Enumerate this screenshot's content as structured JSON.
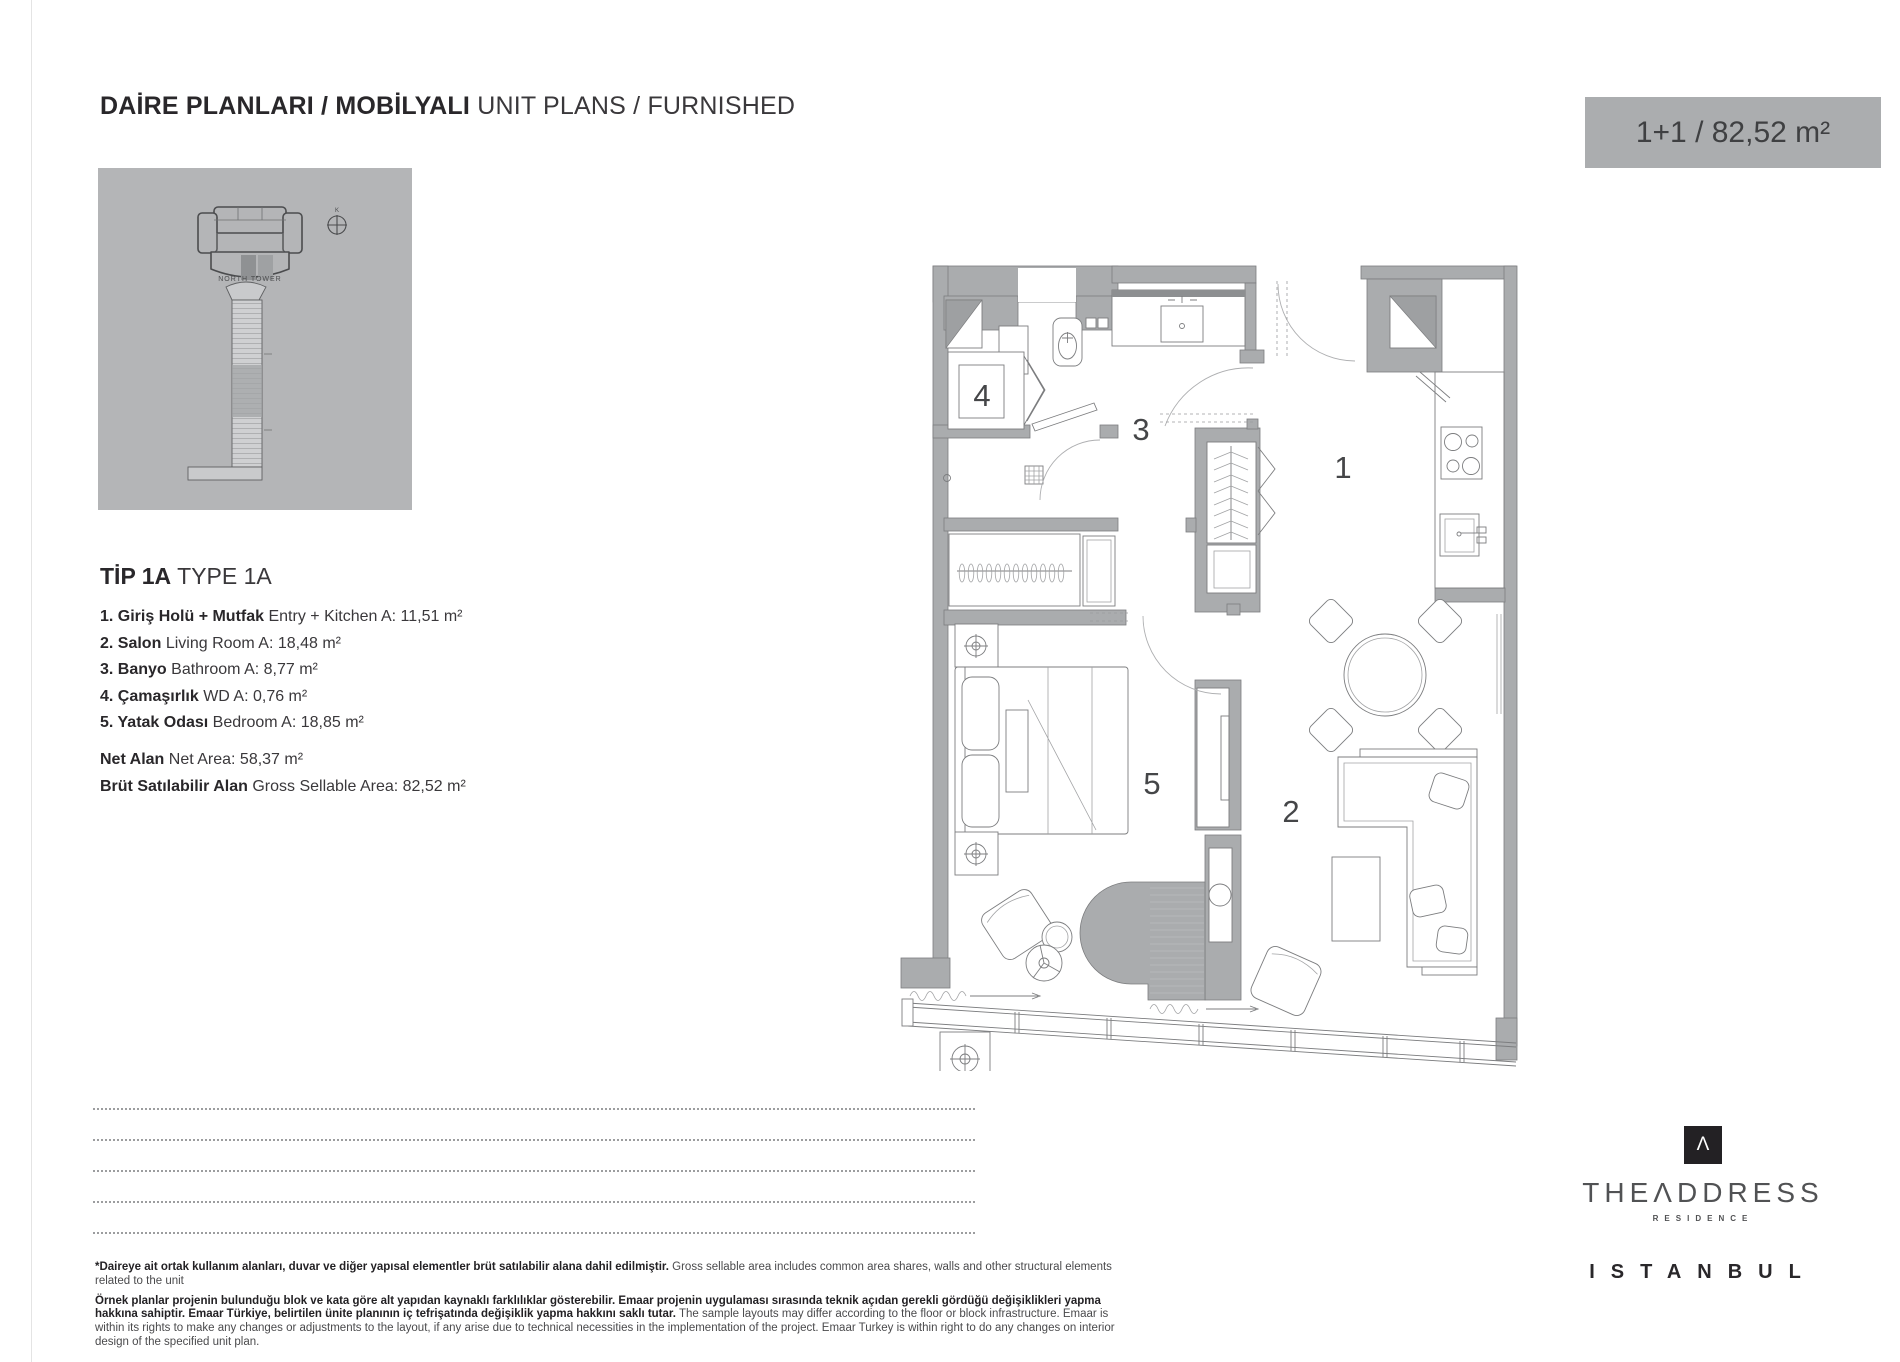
{
  "header": {
    "title_tr": "DAİRE PLANLARI / MOBİLYALI",
    "title_en": "UNIT PLANS / FURNISHED"
  },
  "unit_badge": "1+1 / 82,52 m²",
  "key_plan": {
    "north_letter": "K",
    "tower_name": "NORTH TOWER"
  },
  "unit_type": {
    "code_tr": "TİP 1A",
    "code_en": "TYPE 1A"
  },
  "rooms": [
    {
      "tr": "1. Giriş Holü + Mutfak",
      "en": "Entry + Kitchen A: 11,51 m²"
    },
    {
      "tr": "2. Salon",
      "en": "Living Room A: 18,48 m²"
    },
    {
      "tr": "3. Banyo",
      "en": "Bathroom A: 8,77 m²"
    },
    {
      "tr": "4. Çamaşırlık",
      "en": "WD A: 0,76 m²"
    },
    {
      "tr": "5. Yatak Odası",
      "en": "Bedroom A: 18,85 m²"
    }
  ],
  "totals": [
    {
      "tr": "Net Alan",
      "en": "Net Area: 58,37 m²"
    },
    {
      "tr": "Brüt Satılabilir Alan",
      "en": "Gross Sellable Area: 82,52 m²"
    }
  ],
  "floor_plan": {
    "labels": {
      "entry_kitchen": "1",
      "living_room": "2",
      "bathroom": "3",
      "wd": "4",
      "bedroom": "5"
    }
  },
  "disclaimer": {
    "p1_tr": "*Daireye ait ortak kullanım alanları, duvar ve diğer yapısal elementler brüt satılabilir alana dahil edilmiştir.",
    "p1_en": "Gross sellable area includes common area shares, walls and other structural elements related to the unit",
    "p2_tr": "Örnek planlar projenin bulunduğu blok ve kata göre alt yapıdan kaynaklı farklılıklar gösterebilir. Emaar projenin uygulaması sırasında teknik açıdan gerekli gördüğü değişiklikleri yapma hakkına sahiptir. Emaar Türkiye, belirtilen ünite planının iç tefrişatında değişiklik yapma hakkını saklı tutar.",
    "p2_en": "The sample layouts may differ according to the floor or block infrastructure. Emaar is within its rights to make any changes or adjustments to the layout, if any arise due to technical necessities in the implementation of the project. Emaar Turkey is within right to do any changes on interior design of the specified unit plan."
  },
  "brand": {
    "monogram": "Λ",
    "name": "THEΛDDRESS",
    "division": "RESIDENCE",
    "city": "ISTANBUL"
  },
  "colors": {
    "badge_gray": "#abadaf",
    "panel_gray": "#b4b5b7",
    "wall_gray": "#aaacae",
    "text_dark": "#29272a"
  }
}
